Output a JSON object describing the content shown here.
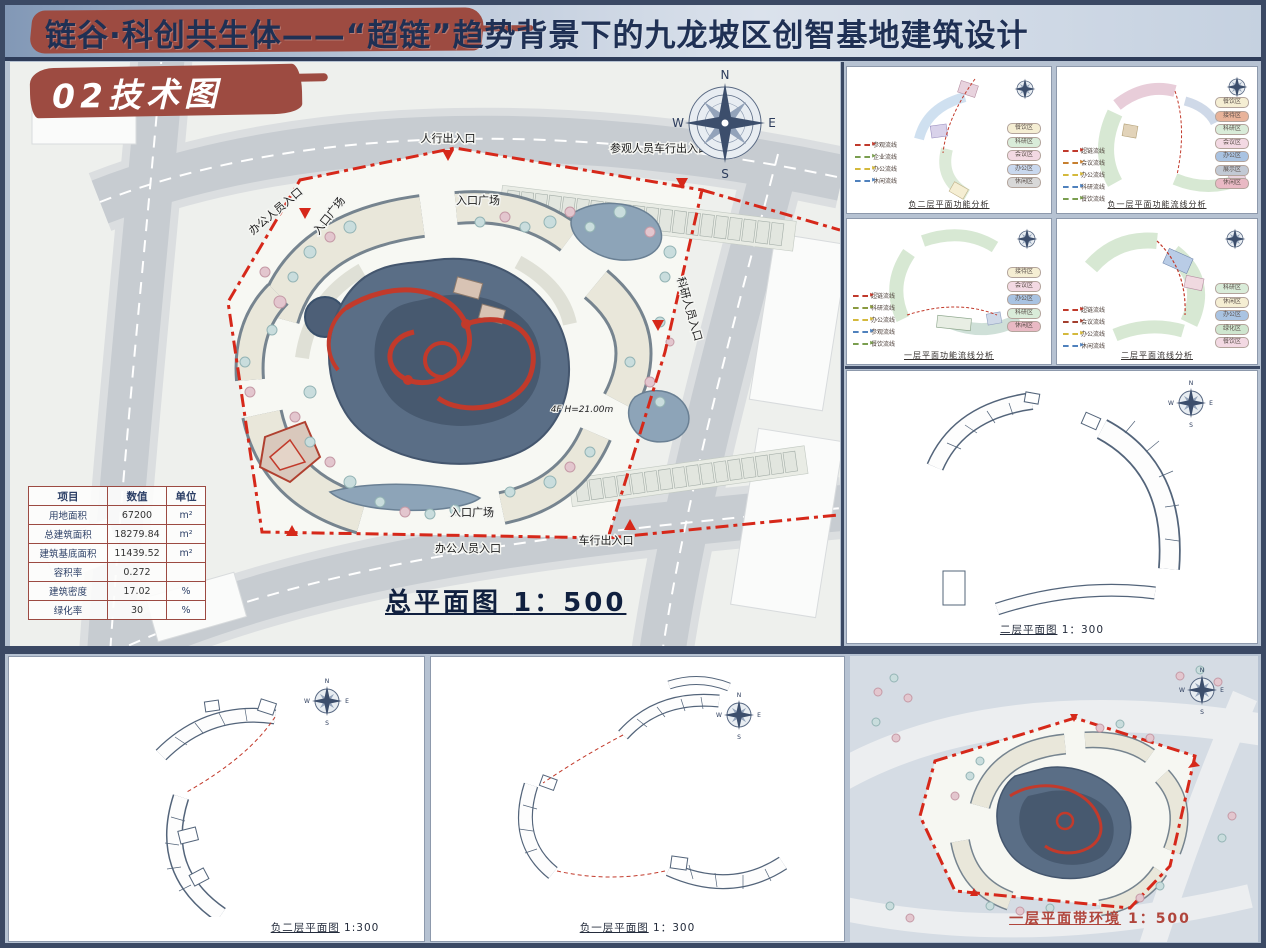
{
  "banner": {
    "title_prefix": "链谷·科创共生体——",
    "title_main": "“超链”趋势背景下的九龙坡区创智基地建筑设计"
  },
  "section": {
    "label": "02技术图"
  },
  "compass": {
    "n": "N",
    "e": "E",
    "s": "S",
    "w": "W"
  },
  "site_plan": {
    "caption": "总平面图",
    "scale": "1：500",
    "labels": {
      "ped_exit": "人行出入口",
      "visitor_vehicle": "参观人员车行出入口",
      "office_entry_top": "办公人员入口",
      "plaza_top": "入口广场",
      "plaza_left": "入口广场",
      "research_entry": "科研人员入口",
      "height_note": "4F H=21.00m",
      "plaza_bottom": "入口广场",
      "office_entry_bottom": "办公人员入口",
      "vehicle_exit": "车行出入口"
    },
    "table": {
      "headers": [
        "项目",
        "数值",
        "单位"
      ],
      "rows": [
        [
          "用地面积",
          "67200",
          "m²"
        ],
        [
          "总建筑面积",
          "18279.84",
          "m²"
        ],
        [
          "建筑基底面积",
          "11439.52",
          "m²"
        ],
        [
          "容积率",
          "0.272",
          ""
        ],
        [
          "建筑密度",
          "17.02",
          "%"
        ],
        [
          "绿化率",
          "30",
          "%"
        ]
      ]
    }
  },
  "analysis_panels": [
    {
      "caption": "负二层平面功能分析",
      "flows": [
        {
          "label": "参观流线",
          "color": "#c0392b"
        },
        {
          "label": "企业流线",
          "color": "#7a9e4f"
        },
        {
          "label": "办公流线",
          "color": "#d4b93c"
        },
        {
          "label": "休闲流线",
          "color": "#4f81bd"
        }
      ],
      "zones": [
        {
          "label": "餐饮区",
          "color": "#f5eed3"
        },
        {
          "label": "科研区",
          "color": "#d9ecd9"
        },
        {
          "label": "会议区",
          "color": "#f3d9e3"
        },
        {
          "label": "办公区",
          "color": "#c9d8ee"
        },
        {
          "label": "休闲区",
          "color": "#d8d8d8"
        }
      ]
    },
    {
      "caption": "负一层平面功能流线分析",
      "flows": [
        {
          "label": "超链流线",
          "color": "#c0392b"
        },
        {
          "label": "会议流线",
          "color": "#c77f2f"
        },
        {
          "label": "办公流线",
          "color": "#d4b93c"
        },
        {
          "label": "科研流线",
          "color": "#4f81bd"
        },
        {
          "label": "餐饮流线",
          "color": "#7a9e4f"
        }
      ],
      "zones": [
        {
          "label": "餐饮区",
          "color": "#f5eed3"
        },
        {
          "label": "接待区",
          "color": "#e8b39a"
        },
        {
          "label": "科研区",
          "color": "#d9ecd9"
        },
        {
          "label": "会议区",
          "color": "#f3d9e3"
        },
        {
          "label": "办公区",
          "color": "#a9c3e2"
        },
        {
          "label": "展示区",
          "color": "#c2c9d4"
        },
        {
          "label": "休闲区",
          "color": "#e9b9c4"
        }
      ]
    },
    {
      "caption": "一层平面功能流线分析",
      "flows": [
        {
          "label": "超链流线",
          "color": "#c0392b"
        },
        {
          "label": "科研流线",
          "color": "#8a9a3f"
        },
        {
          "label": "办公流线",
          "color": "#d4b93c"
        },
        {
          "label": "参观流线",
          "color": "#4f81bd"
        },
        {
          "label": "餐饮流线",
          "color": "#7a9e4f"
        }
      ],
      "zones": [
        {
          "label": "接待区",
          "color": "#f5eed3"
        },
        {
          "label": "会议区",
          "color": "#f3d9e3"
        },
        {
          "label": "办公区",
          "color": "#a9c3e2"
        },
        {
          "label": "科研区",
          "color": "#d9ecd9"
        },
        {
          "label": "休闲区",
          "color": "#e9b9c4"
        }
      ]
    },
    {
      "caption": "二层平面流线分析",
      "flows": [
        {
          "label": "超链流线",
          "color": "#c0392b"
        },
        {
          "label": "会议流线",
          "color": "#a33e2e"
        },
        {
          "label": "办公流线",
          "color": "#d4b93c"
        },
        {
          "label": "休闲流线",
          "color": "#4f81bd"
        }
      ],
      "zones": [
        {
          "label": "科研区",
          "color": "#d9ecd9"
        },
        {
          "label": "休闲区",
          "color": "#f5eed3"
        },
        {
          "label": "办公区",
          "color": "#a9c3e2"
        },
        {
          "label": "绿化区",
          "color": "#cfe6cf"
        },
        {
          "label": "餐饮区",
          "color": "#f3d9e3"
        }
      ]
    }
  ],
  "floor_plans": {
    "second": {
      "caption": "二层平面图",
      "scale": "1：300"
    },
    "b2": {
      "caption": "负二层平面图",
      "scale": "1:300"
    },
    "b1": {
      "caption": "负一层平面图",
      "scale": "1：300"
    },
    "first_env": {
      "caption": "一层平面带环境",
      "scale": "1：500"
    }
  },
  "colors": {
    "frame": "#3b4964",
    "page_bg": "#b6c2d2",
    "banner_text": "#1f3054",
    "brush_red": "#9d4b41",
    "boundary_red": "#d6281a",
    "building_slate": "#5a6e86",
    "path_red": "#c23a2b",
    "table_border": "#9c4a42",
    "caption_red": "#b0453c"
  }
}
